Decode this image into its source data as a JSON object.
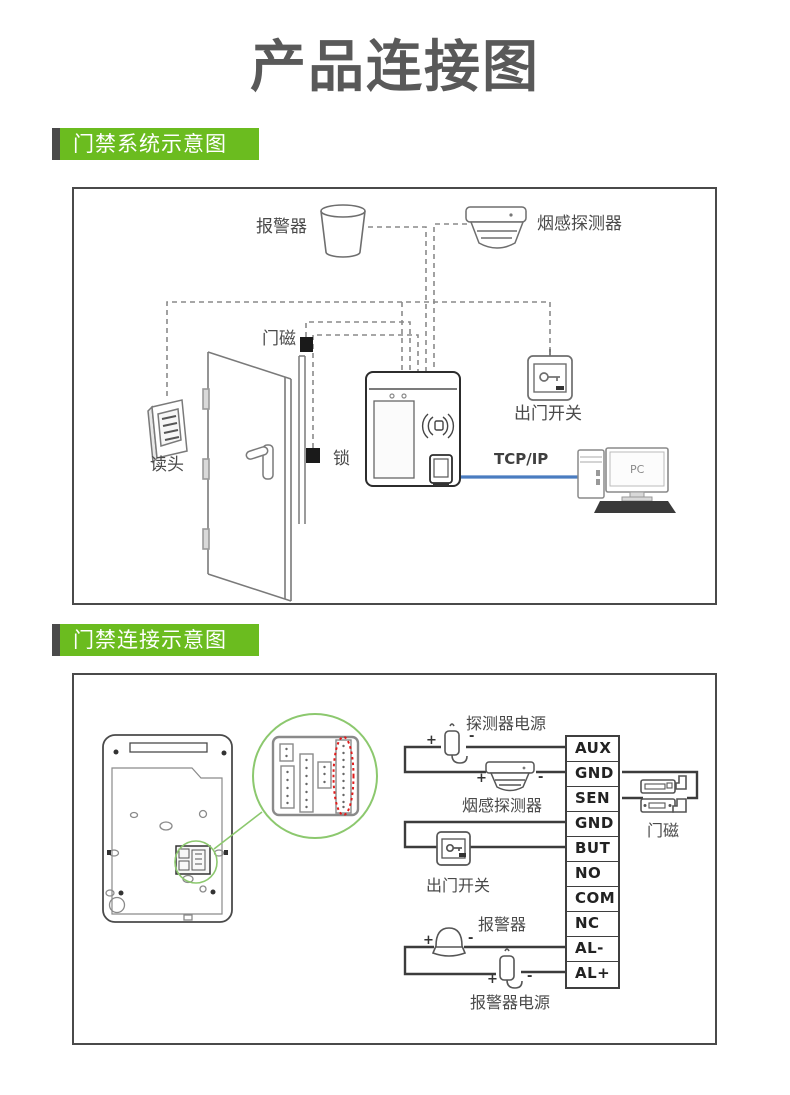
{
  "page": {
    "title": "产品连接图"
  },
  "sections": [
    {
      "title": "门禁系统示意图"
    },
    {
      "title": "门禁连接示意图"
    }
  ],
  "colors": {
    "accent_green": "#6bbc1f",
    "label_bar_gray": "#4a4a4a",
    "wire_blue": "#4a7cc0",
    "highlight_red": "#e01b1b",
    "magnifier_green": "#8cc86e"
  },
  "diagram1": {
    "labels": {
      "alarm": "报警器",
      "smoke_detector": "烟感探测器",
      "door_magnet": "门磁",
      "reader": "读头",
      "lock": "锁",
      "exit_switch": "出门开关",
      "tcpip": "TCP/IP",
      "pc": "PC"
    }
  },
  "diagram2": {
    "labels": {
      "detector_power": "探测器电源",
      "smoke_detector": "烟感探测器",
      "exit_switch": "出门开关",
      "alarm": "报警器",
      "alarm_power": "报警器电源",
      "door_magnet": "门磁"
    },
    "signs": {
      "plus": "+",
      "minus": "-"
    },
    "terminal_block": {
      "rows": [
        "AUX",
        "GND",
        "SEN",
        "GND",
        "BUT",
        "NO",
        "COM",
        "NC",
        "AL-",
        "AL+"
      ]
    }
  }
}
